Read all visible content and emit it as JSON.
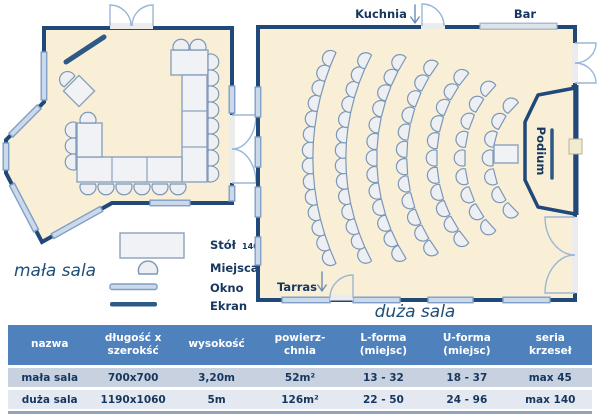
{
  "plan": {
    "small_room": {
      "label": "mała sala"
    },
    "large_room": {
      "label": "duża sala",
      "kuchnia_label": "Kuchnia",
      "bar_label": "Bar",
      "tarras_label": "Tarras",
      "podium_label": "Podium"
    },
    "legend": {
      "table_label": "Stół",
      "table_size": "140x100",
      "seats_label": "Miejsca",
      "window_label": "Okno",
      "screen_label": "Ekran"
    }
  },
  "specs_table": {
    "headers": [
      "nazwa",
      "długość x\nszerokść",
      "wysokość",
      "powierz-\nchnia",
      "L-forma\n(miejsc)",
      "U-forma\n(miejsc)",
      "seria\nkrzeseł"
    ],
    "rows": [
      {
        "cells": [
          "mała sala",
          "700x700",
          "3,20m",
          "52m²",
          "13 - 32",
          "18 - 37",
          "max 45"
        ]
      },
      {
        "cells": [
          "duża sala",
          "1190x1060",
          "5m",
          "126m²",
          "22 - 50",
          "24 - 96",
          "max 140"
        ]
      }
    ]
  },
  "colors": {
    "wall": "#20497a",
    "floor": "#f9efd7",
    "window": "#ccd9ea",
    "screen": "#2d5986",
    "table_header_bg": "#4f81bd",
    "row_a_bg": "#c7d1e0",
    "row_b_bg": "#e4e9f1",
    "text_navy": "#17375e"
  }
}
